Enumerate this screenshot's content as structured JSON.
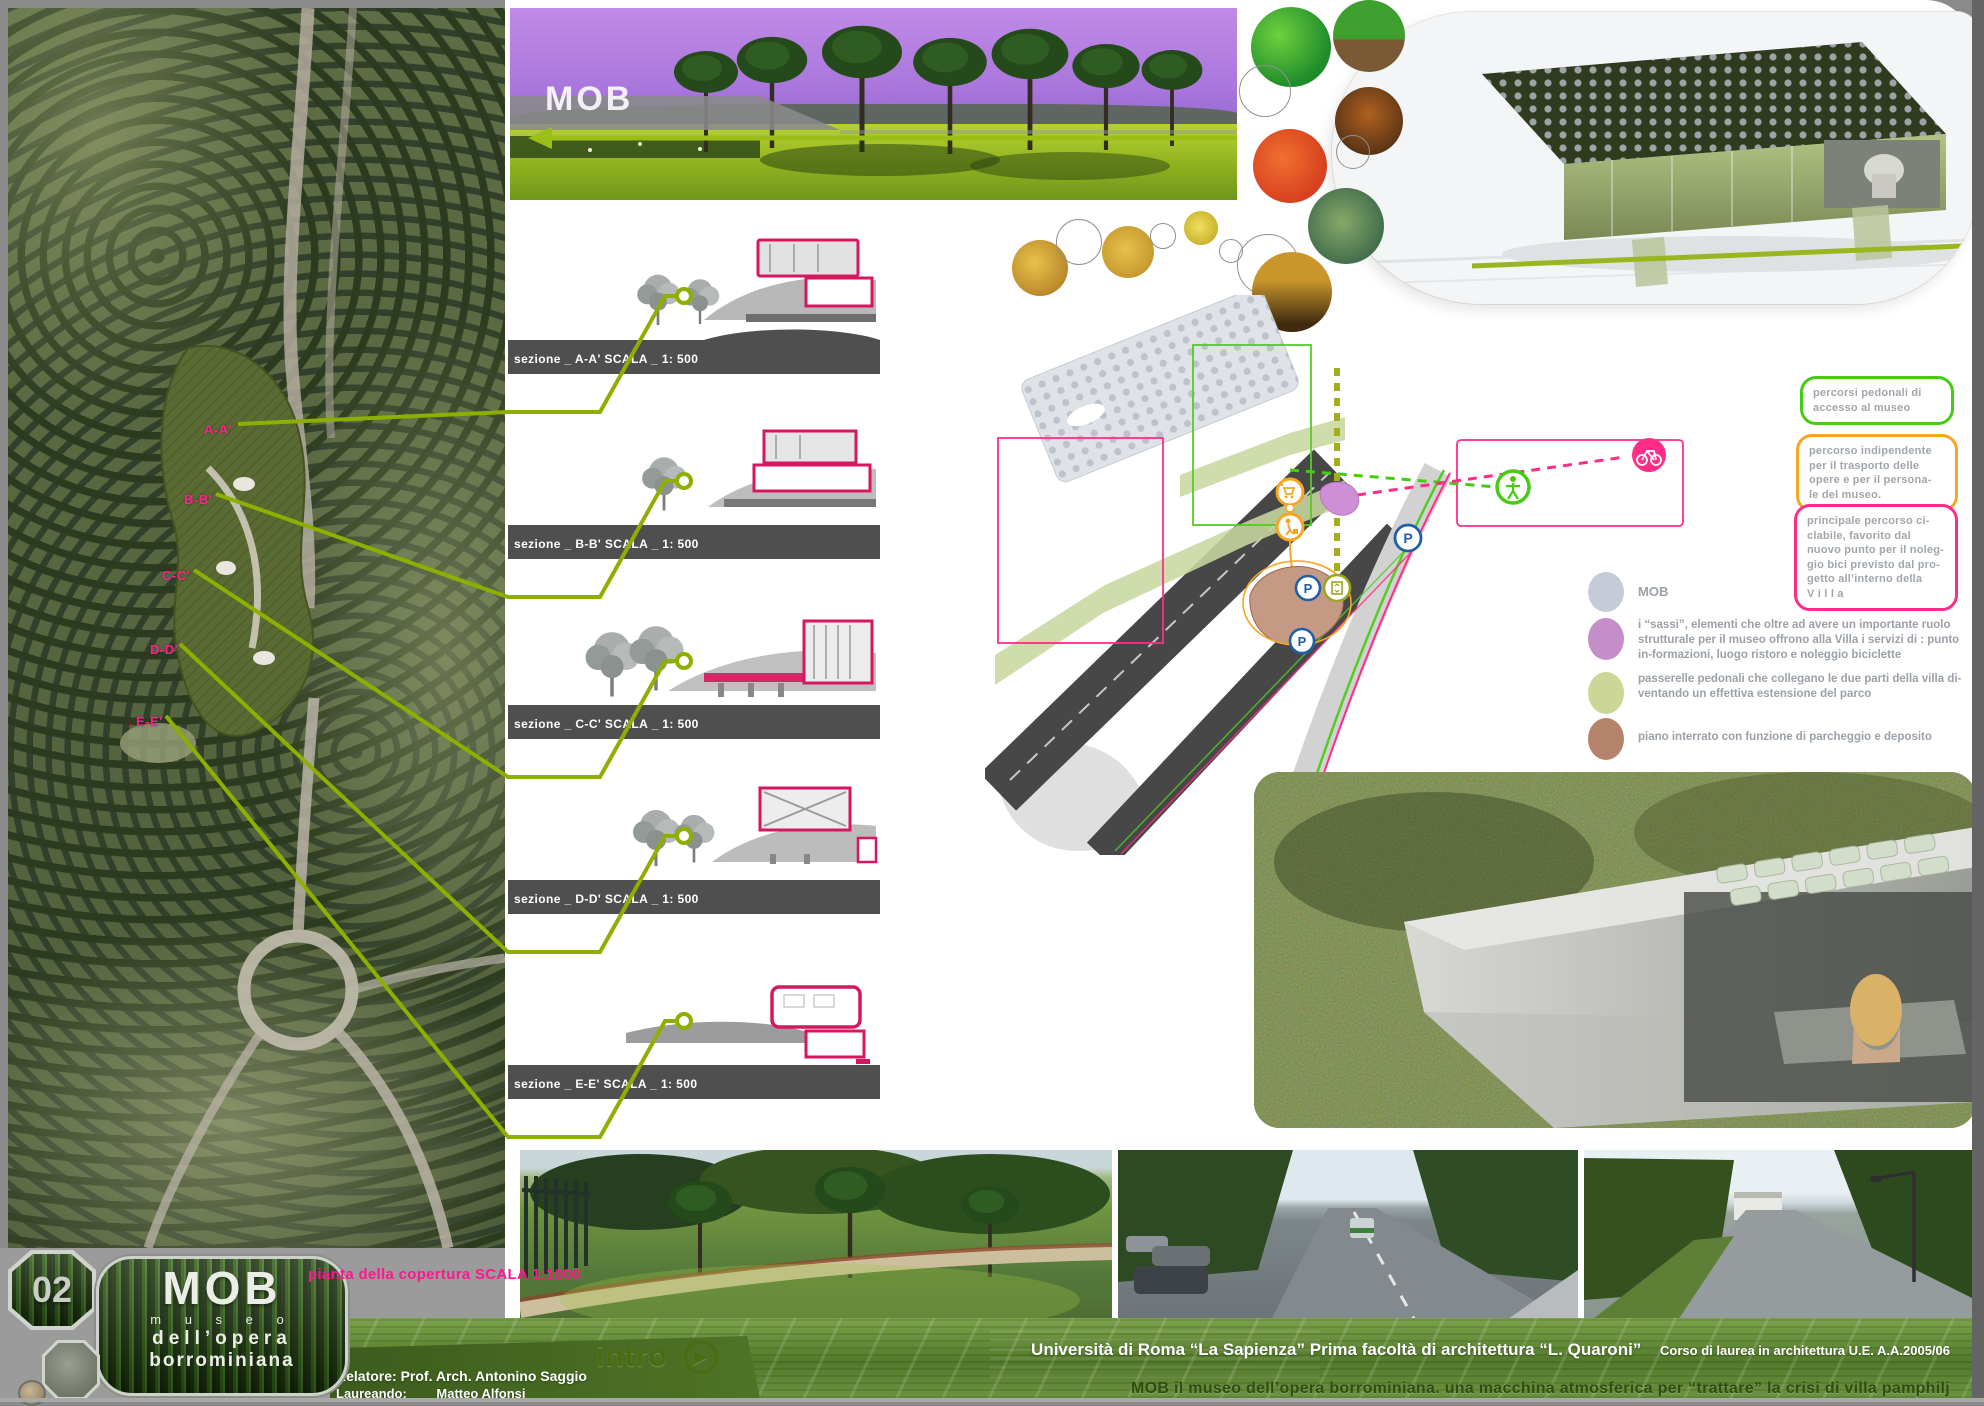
{
  "board": {
    "panel_number": "02",
    "logo": {
      "title": "MOB",
      "sub1": "m u s e o",
      "sub2": "dell’opera",
      "sub3": "borrominiana"
    },
    "credits": {
      "relatore": "Relatore: Prof. Arch. Antonino Saggio",
      "laureando_label": "Laureando:",
      "laureando_name": "Matteo Alfonsi"
    },
    "nav": {
      "intro_label": "intro"
    },
    "footer": {
      "university_line": "Università di Roma “La Sapienza”   Prima facoltà di architettura “L. Quaroni”",
      "course_line": "Corso di laurea in architettura U.E.  A.A.2005/06",
      "title_line": "MOB  il museo dell’opera borrominiana. una macchina atmosferica per “trattare” la crisi di villa pamphilj"
    }
  },
  "site_plan": {
    "caption": "pianta della copertura  SCALA 1:1000",
    "section_markers": [
      "A-A'",
      "B-B'",
      "C-C'",
      "D-D'",
      "E-E'"
    ]
  },
  "panorama": {
    "label": "MOB"
  },
  "sections": [
    {
      "label": "sezione _ A-A' SCALA _ 1: 500"
    },
    {
      "label": "sezione _ B-B' SCALA _ 1: 500"
    },
    {
      "label": "sezione _ C-C' SCALA _ 1: 500"
    },
    {
      "label": "sezione _ D-D' SCALA _ 1: 500"
    },
    {
      "label": "sezione _ E-E' SCALA _ 1: 500"
    }
  ],
  "diagram": {
    "boxes": [
      {
        "text": "percorsi pedonali di\naccesso al museo",
        "color": "#44cc11"
      },
      {
        "text": "percorso indipendente\nper il trasporto delle\nopere e per il persona-\nle del museo.",
        "color": "#f5a623"
      },
      {
        "text": "principale percorso ci-\nclabile, favorito dal\nnuovo punto per il noleg-\ngio bici previsto dal pro-\ngetto all’interno della\nV   i   l   l   a",
        "color": "#ff2d87"
      }
    ],
    "legend": [
      {
        "label": "MOB",
        "color": "#c6cbd8"
      },
      {
        "label": "i “sassi”,   elementi che oltre ad avere un importante ruolo strutturale per il museo offrono alla Villa i servizi di : punto in-formazioni, luogo ristoro e noleggio biciclette",
        "color": "#c48fc9"
      },
      {
        "label": "passerelle pedonali che collegano le due parti della villa di-ventando un effettiva estensione del parco",
        "color": "#ccd697"
      },
      {
        "label": "piano interrato  con funzione di parcheggio e deposito",
        "color": "#b5826b"
      }
    ],
    "icons": {
      "parking": "P"
    }
  }
}
